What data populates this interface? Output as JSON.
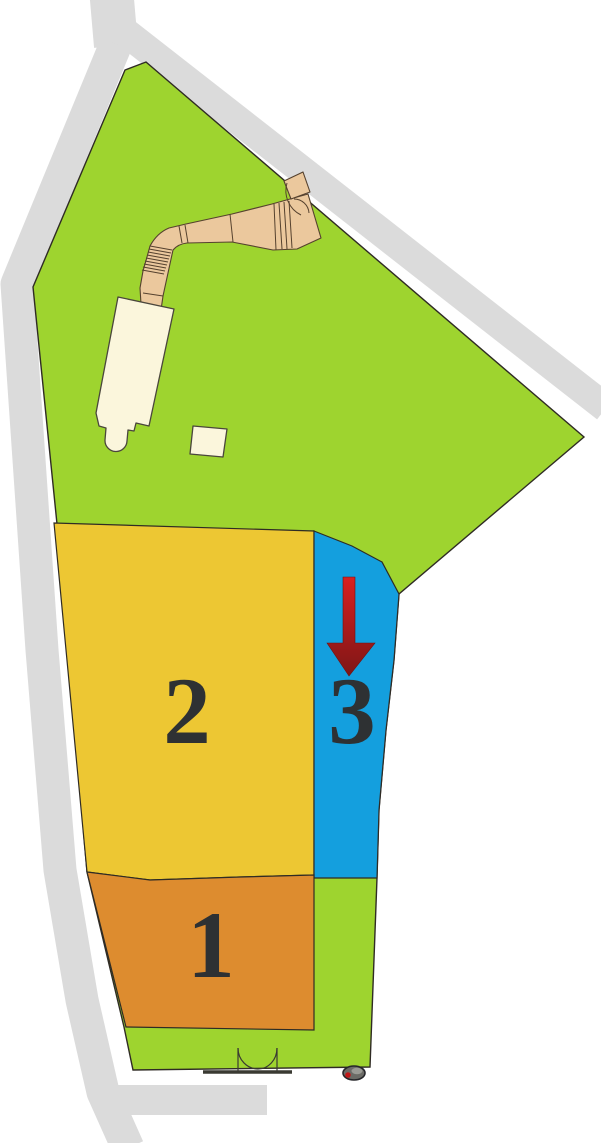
{
  "title": "site-plan-map",
  "canvas": {
    "width": 601,
    "height": 1143
  },
  "zones": [
    {
      "id": "zone-1",
      "label": "1",
      "fill": "#DD8C2F"
    },
    {
      "id": "zone-2",
      "label": "2",
      "fill": "#EDC733"
    },
    {
      "id": "zone-3",
      "label": "3",
      "fill": "#149FDE"
    }
  ],
  "landscape": {
    "site_fill": "#9ED42F",
    "road_fill": "#DBDBDB",
    "walkway_fill": "#EBC89D",
    "building_fill": "#FBF6DC",
    "outline_color": "#2F2B24"
  },
  "arrow": {
    "name": "entrance-direction-arrow",
    "color_top": "#D92020",
    "color_bottom": "#7E1616"
  },
  "icons": [
    {
      "name": "gate-icon",
      "meaning": "double swing gate at south boundary"
    },
    {
      "name": "vehicle-icon",
      "meaning": "small vehicle marker at south-east corner"
    },
    {
      "name": "stairs-treads",
      "meaning": "stair steps on walkway"
    },
    {
      "name": "entrance-arrow-icon",
      "meaning": "red arrow pointing down into zone 3"
    }
  ]
}
